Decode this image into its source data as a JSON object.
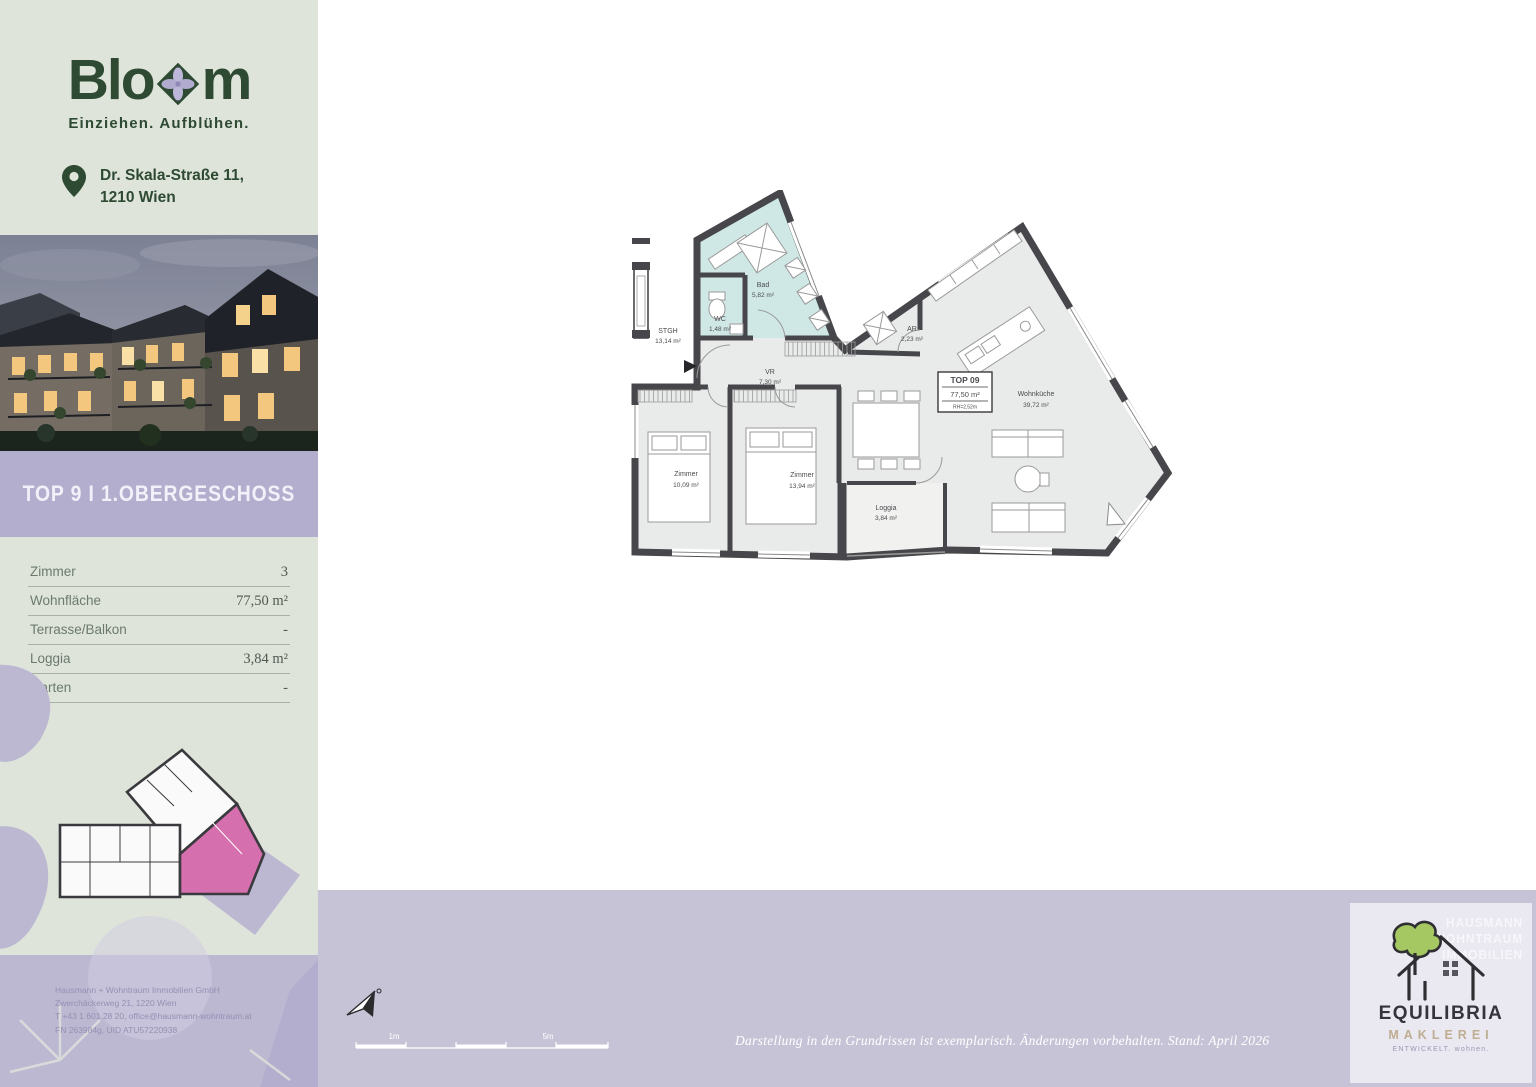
{
  "sidebar": {
    "logo": {
      "word_start": "Blo",
      "word_end": "m",
      "tagline": "Einziehen. Aufblühen."
    },
    "address": {
      "line1": "Dr. Skala-Straße 11,",
      "line2": "1210 Wien"
    },
    "unit_header": "TOP 9 I 1.OBERGESCHOSS",
    "facts": [
      {
        "label": "Zimmer",
        "value": "3"
      },
      {
        "label": "Wohnfläche",
        "value": "77,50 m²"
      },
      {
        "label": "Terrasse/Balkon",
        "value": "-"
      },
      {
        "label": "Loggia",
        "value": "3,84 m²"
      },
      {
        "label": "Garten",
        "value": "-"
      }
    ],
    "company_lines": [
      "Hausmann + Wohntraum Immobilien GmbH",
      "Zwerchäckerweg 21, 1220 Wien",
      "T +43 1 601 28 20, office@hausmann-wohntraum.at",
      "FN 263984g, UID ATU57220938"
    ]
  },
  "plan": {
    "unit_box": {
      "title": "TOP 09",
      "area": "77,50 m²",
      "note": "RH=2,52m"
    },
    "rooms": {
      "stgh": {
        "name": "STGH",
        "area": "13,14 m²"
      },
      "wc": {
        "name": "WC",
        "area": "1,48 m²"
      },
      "bad": {
        "name": "Bad",
        "area": "5,82 m²"
      },
      "vr": {
        "name": "VR",
        "area": "7,30 m²"
      },
      "ar": {
        "name": "AR",
        "area": "2,23 m²"
      },
      "kitchen": {
        "name": "Wohnküche",
        "area": "39,72 m²"
      },
      "zimmer1": {
        "name": "Zimmer",
        "area": "10,09 m²"
      },
      "zimmer2": {
        "name": "Zimmer",
        "area": "13,94 m²"
      },
      "loggia": {
        "name": "Loggia",
        "area": "3,84 m²"
      }
    },
    "scale": {
      "label1": "1m",
      "label2": "5m"
    }
  },
  "footer": {
    "disclaimer": "Darstellung in den Grundrissen ist exemplarisch. Änderungen vorbehalten. Stand: April 2026",
    "broker": {
      "name": "EQUILIBRIA",
      "division": "MAKLEREI",
      "tagline": "ENTWICKELT. wohnen.",
      "watermark1": "HAUSMANN",
      "watermark2": "WOHNTRAUM",
      "watermark3": "IMMOBILIEN"
    }
  },
  "colors": {
    "sage": "#dfe4db",
    "band_purple": "#b3aecd",
    "footer_lavender": "#c6c3d7",
    "logo_green": "#2e4a33",
    "teal_room": "#cfe8e5",
    "highlight_pink": "#d56fad"
  }
}
